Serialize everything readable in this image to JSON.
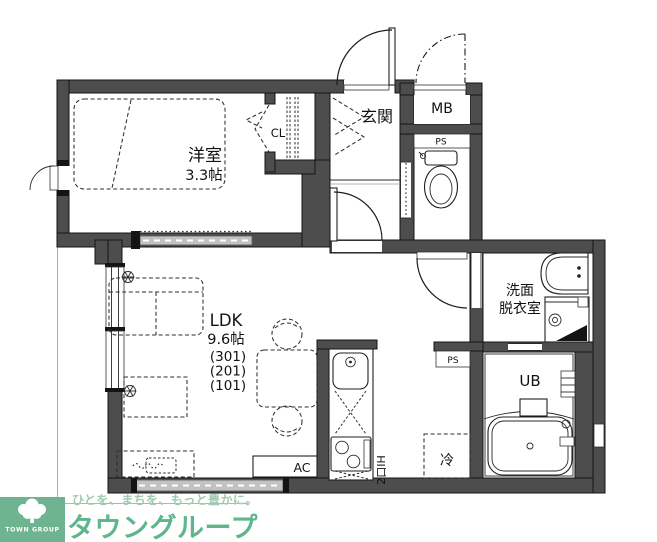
{
  "plan": {
    "rooms": {
      "yoshitsu": {
        "label": "洋室",
        "size": "3.3帖"
      },
      "cl": {
        "label": "CL"
      },
      "genkan": {
        "label": "玄関"
      },
      "mb": {
        "label": "MB"
      },
      "ps_upper": {
        "label": "PS"
      },
      "ps_lower": {
        "label": "PS"
      },
      "ldk": {
        "label": "LDK",
        "size": "9.6帖",
        "units": [
          "(301)",
          "(201)",
          "(101)"
        ]
      },
      "senmen": {
        "line1": "洗面",
        "line2": "脱衣室"
      },
      "ub": {
        "label": "UB"
      },
      "fridge": {
        "label": "冷"
      },
      "ac": {
        "label": "AC"
      },
      "stove": {
        "label": "2口IH"
      }
    }
  },
  "footer": {
    "tagline": "ひとを、まちを、もっと豊かに。",
    "brand": "タウングループ",
    "logo_text": "TOWN GROUP"
  },
  "colors": {
    "wall": "#4d4d4d",
    "glass": "#c2c2c2",
    "brand_green": "#5eb68d",
    "tagline_green": "#a2c9b1",
    "logo_bg": "#6eb490"
  }
}
